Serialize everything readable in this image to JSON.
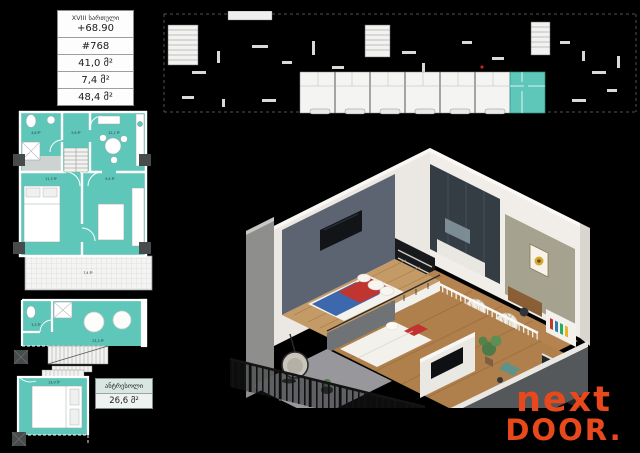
{
  "info_table": {
    "floor": "XVIII სართული",
    "elevation": "+68.90",
    "unit_number": "#768",
    "area_living": "41,0 მ²",
    "area_balcony": "7,4 მ²",
    "area_total": "48,4 მ²"
  },
  "mezzanine_label": {
    "title": "ანტრესოლი",
    "area": "26,6 მ²"
  },
  "plans": {
    "main": {
      "wc": "4,6 მ²",
      "hall": "5,6 მ²",
      "kitchen": "12,1 მ²",
      "bedroom": "11,3 მ²",
      "living": "9,4 მ²",
      "balcony": "7,4 მ²"
    },
    "mezzanine": {
      "wc": "3,3 მ²",
      "room": "23,3 მ²"
    },
    "lower_bedroom": {
      "room": "13,9 მ²"
    }
  },
  "logo": {
    "line1": "next",
    "line2": "DOOR",
    "dot": ".",
    "color": "#e8481c"
  },
  "colors": {
    "background": "#000000",
    "plan_teal": "#5fc7b9",
    "highlight_teal": "#5fc7b9",
    "logo_orange": "#e8481c"
  }
}
